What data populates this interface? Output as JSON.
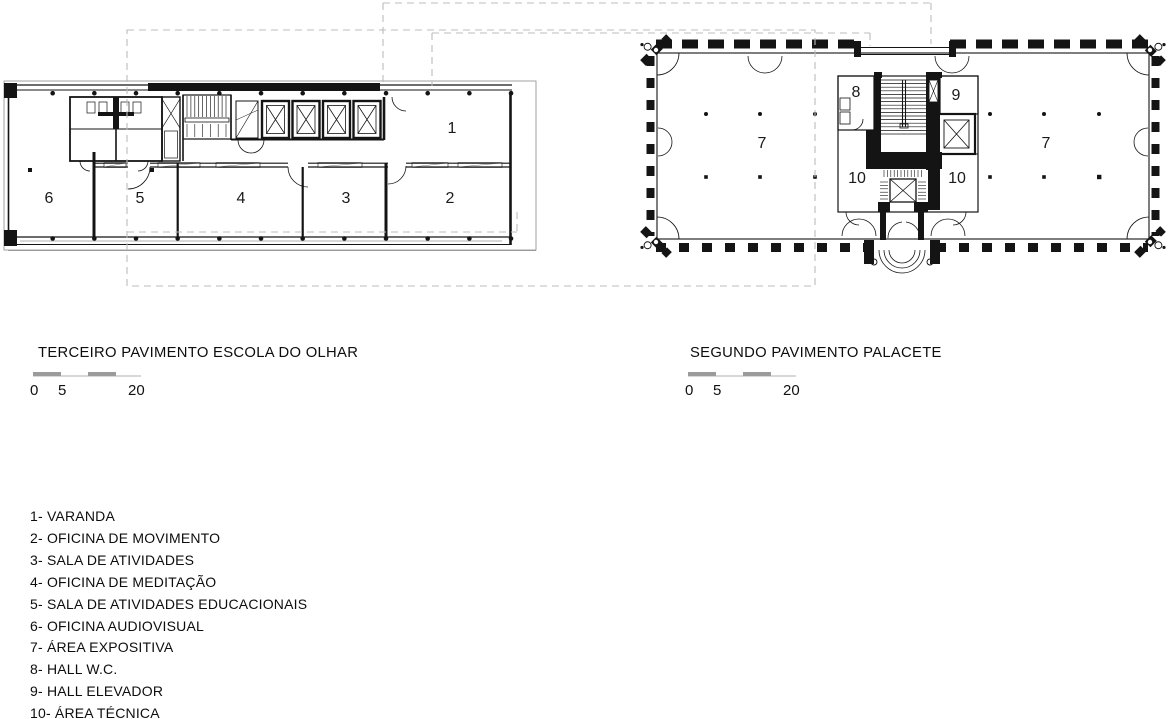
{
  "plan1": {
    "title": "TERCEIRO PAVIMENTO ESCOLA DO OLHAR",
    "scale_labels": [
      "0",
      "5",
      "20"
    ],
    "room_labels": {
      "r1": "1",
      "r2": "2",
      "r3": "3",
      "r4": "4",
      "r5": "5",
      "r6": "6"
    }
  },
  "plan2": {
    "title": "SEGUNDO PAVIMENTO PALACETE",
    "scale_labels": [
      "0",
      "5",
      "20"
    ],
    "room_labels": {
      "hall_left": "7",
      "hall_right": "7",
      "hall_wc": "8",
      "hall_elevator": "9",
      "tech_left": "10",
      "tech_right": "10"
    }
  },
  "legend": {
    "items": [
      "1- VARANDA",
      "2- OFICINA DE MOVIMENTO",
      "3- SALA DE ATIVIDADES",
      "4- OFICINA DE MEDITAÇÃO",
      "5- SALA DE ATIVIDADES EDUCACIONAIS",
      "6- OFICINA AUDIOVISUAL",
      "7- ÁREA EXPOSITIVA",
      "8- HALL W.C.",
      "9- HALL ELEVADOR",
      "10- ÁREA TÉCNICA"
    ]
  },
  "colors": {
    "ink": "#141414",
    "dash_overlay": "#bcbcbc",
    "scale_dark": "#9b9b9b",
    "scale_light": "#d8d8d8"
  }
}
